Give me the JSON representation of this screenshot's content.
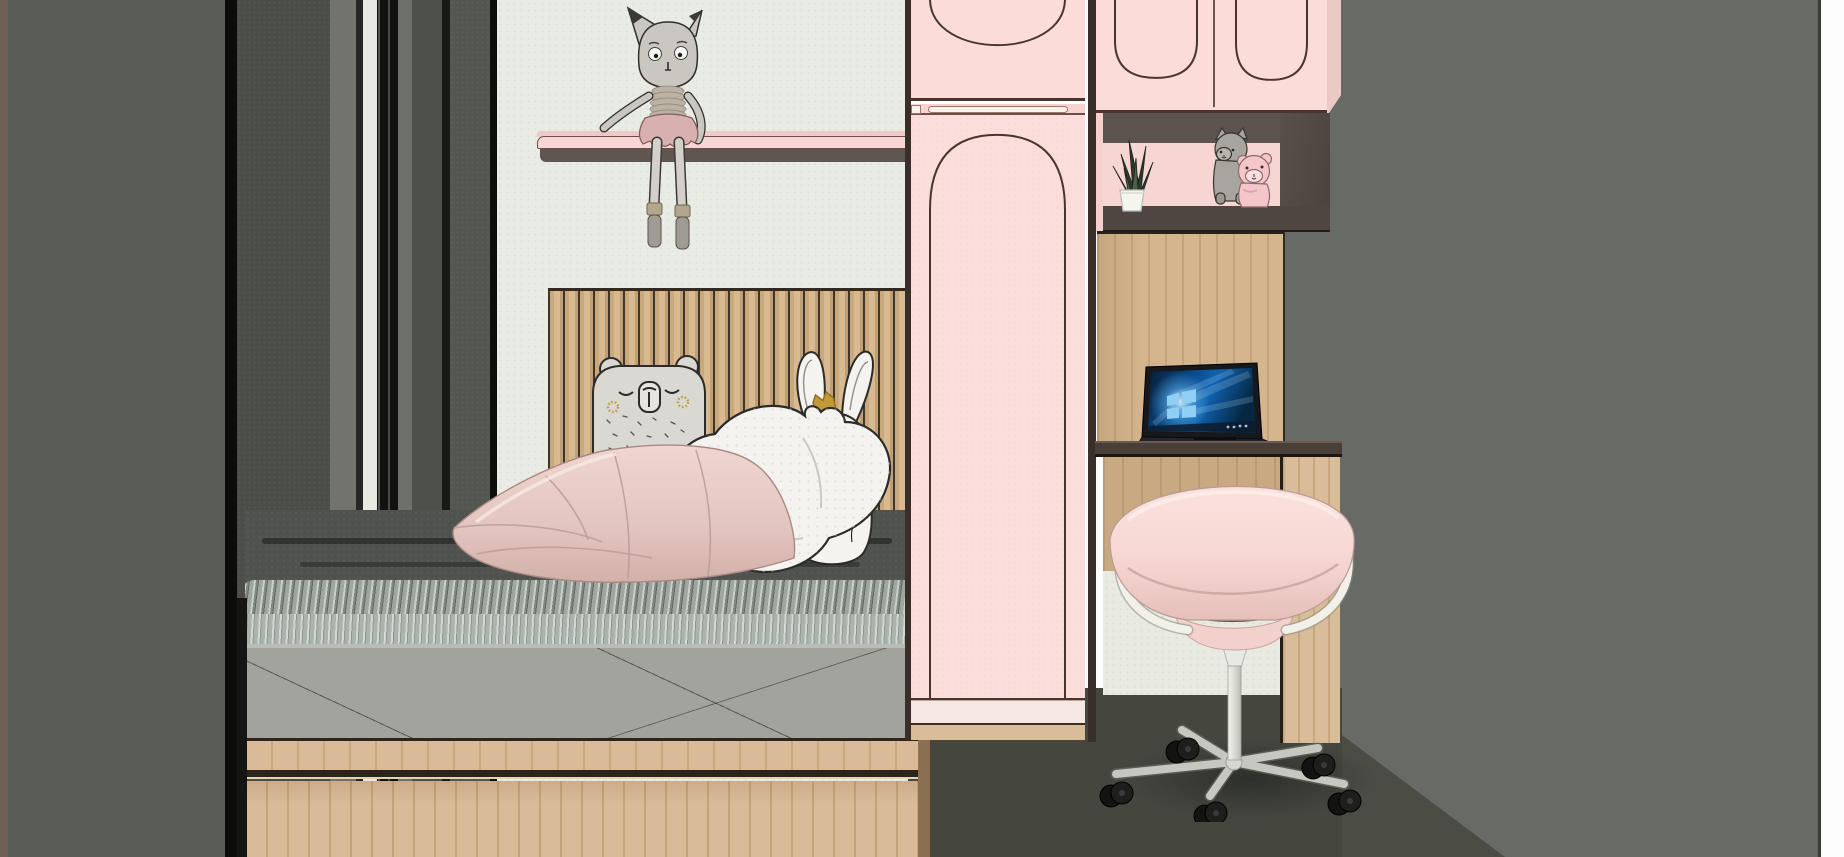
{
  "scene": {
    "type": "3d-interior-render",
    "room": "kids bedroom with bed, pink wardrobe, desk nook and swivel chair",
    "objects": [
      {
        "name": "dark-panel-wall",
        "position": "left"
      },
      {
        "name": "mint-wall",
        "position": "center-left"
      },
      {
        "name": "wall-shelf",
        "holds": "rag-doll"
      },
      {
        "name": "rag-doll-with-dangling-legs"
      },
      {
        "name": "slat-headboard"
      },
      {
        "name": "bed-with-drawer-base"
      },
      {
        "name": "gray-knit-blanket"
      },
      {
        "name": "pink-pillow"
      },
      {
        "name": "bear-pillow"
      },
      {
        "name": "heart-pillow"
      },
      {
        "name": "bunny-pillow-with-crown"
      },
      {
        "name": "pink-wardrobe-arched-door"
      },
      {
        "name": "overhead-cabinets-arched"
      },
      {
        "name": "display-niche",
        "holds": "snake-plant, plush toys"
      },
      {
        "name": "snake-plant-in-white-pot"
      },
      {
        "name": "plush-cat-and-pink-bear"
      },
      {
        "name": "desk-nook-wood-panel"
      },
      {
        "name": "laptop-windows-wallpaper"
      },
      {
        "name": "pink-swivel-chair-casters"
      },
      {
        "name": "dark-gray-floor"
      },
      {
        "name": "gray-right-wall"
      }
    ]
  },
  "palette": {
    "wallMint": "#e9ece4",
    "wallRight": "#686a66",
    "floorDark": "#45473f",
    "floorLight": "#4b4d45",
    "panelGray": "#5a5c58",
    "panelGray2": "#4b4d49",
    "panelBrown": "#6e6053",
    "pinkCabinet": "#fbdcd8",
    "pinkDoor": "#fbdedb",
    "pinkPlinth": "#f5e8e2",
    "shelfPink": "#f7d6d3",
    "outlineDark": "#4a352e",
    "gapShadow": "#3a2e28",
    "nicheFrame": "#5d534e",
    "nicheBack": "#f7d5d2",
    "nicheShelf": "#4f4641",
    "woodPanel": "#d5b58d",
    "woodUnder": "#c9a981",
    "woodBase": "#d9bc98",
    "deskTop": "#4a3e38",
    "underWall": "#e9eae2",
    "blanketDark": "#4f524f",
    "mattress": "#a3a39d",
    "bedWood": "#d9bc97",
    "plushWhite": "#f4f3f0",
    "plushGray": "#dad8d3",
    "inkOutline": "#2b2b28",
    "pillowPink": "#e3c5bf",
    "chairPink": "#f8dbd7",
    "chairInner": "#8c7672",
    "chairMetal": "#d7d8d2",
    "casterBlack": "#161614",
    "dollBody": "#cac7c1",
    "dollSkirt": "#d8b0b0",
    "gold": "#c49a36",
    "leafGreen": "#2e3a2d",
    "potWhite": "#f4f4f0",
    "whiteEdge": "#fdfdfd"
  }
}
